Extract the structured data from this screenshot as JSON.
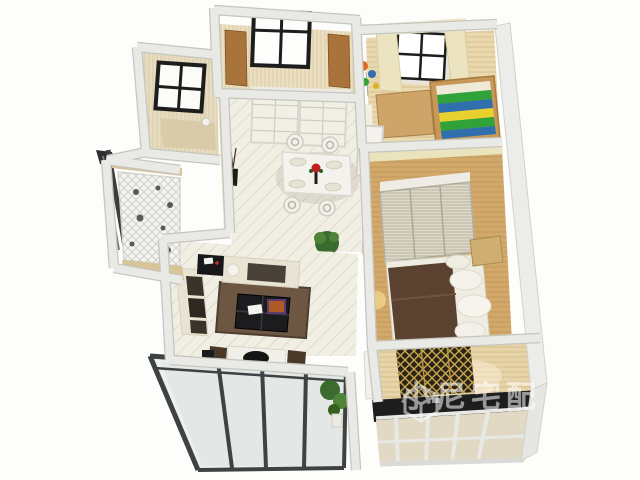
{
  "watermark": {
    "text": "小尼宅配",
    "color": "#ffffff",
    "opacity": 0.55,
    "logo": "cube-logo-icon"
  },
  "palette": {
    "wall": "#e9e9e5",
    "wallEdge": "#c6c6bf",
    "beigeWall": "#e8dcc0",
    "tileFloor": "#f1eee4",
    "woodFloor": "#d2a96a",
    "lightWood": "#ebd9ae",
    "studyWood": "#e7d5a8",
    "sofa": "#e9e3d3",
    "cushion": "#3a332a",
    "rug": "#6d5743",
    "duvet": "#5a4130",
    "blackFurniture": "#1c1c1e",
    "windowFrame": "#1d1d1d",
    "balconyFrame": "#3f4242",
    "glass": "#e4eae8",
    "whiteFrame": "#e8e8e4",
    "cabinetWood": "#a9743c",
    "bedWood": "#c89858",
    "stripeGreen": "#2fa33a",
    "stripeBlue": "#2f6fae",
    "stripeYellow": "#e8d12f",
    "lattice": "#c9a84c",
    "plant": "#3c6b2f",
    "flower": "#c41e1e",
    "whiteFurniture": "#f1efe7"
  }
}
